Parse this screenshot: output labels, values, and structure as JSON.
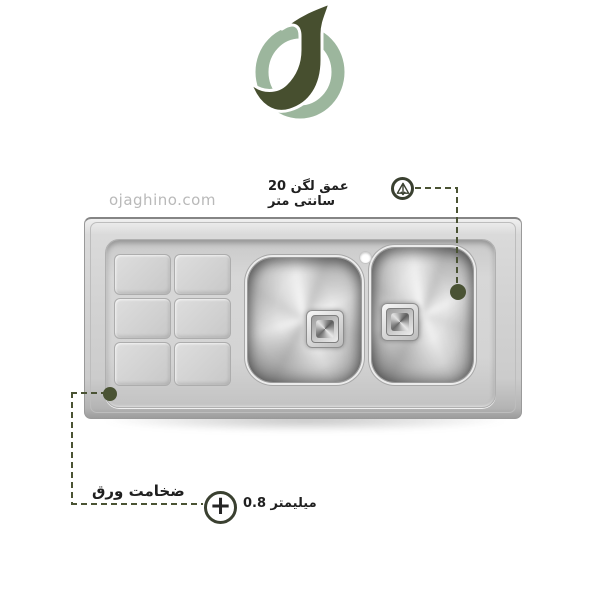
{
  "page": {
    "background_color": "#ffffff"
  },
  "brand": {
    "watermark": "ojaghino.com",
    "logo": {
      "letter": "J",
      "dark_color": "#474f2f",
      "light_color": "#9cb69d"
    }
  },
  "annotations": {
    "line_color": "#4a5334",
    "icon_ring_color": "#3a4030",
    "depth": {
      "label": "عمق لگن 20 سانتی متر"
    },
    "thickness": {
      "label": "ضخامت ورق",
      "value": "میلیمتر 0.8",
      "plus_glyph": "+"
    }
  },
  "product_drawing": {
    "type": "stainless-steel-double-bowl-sink-with-drainboard",
    "bowls": 2,
    "drainboard_squares": 6,
    "faucet_holes": 1
  }
}
